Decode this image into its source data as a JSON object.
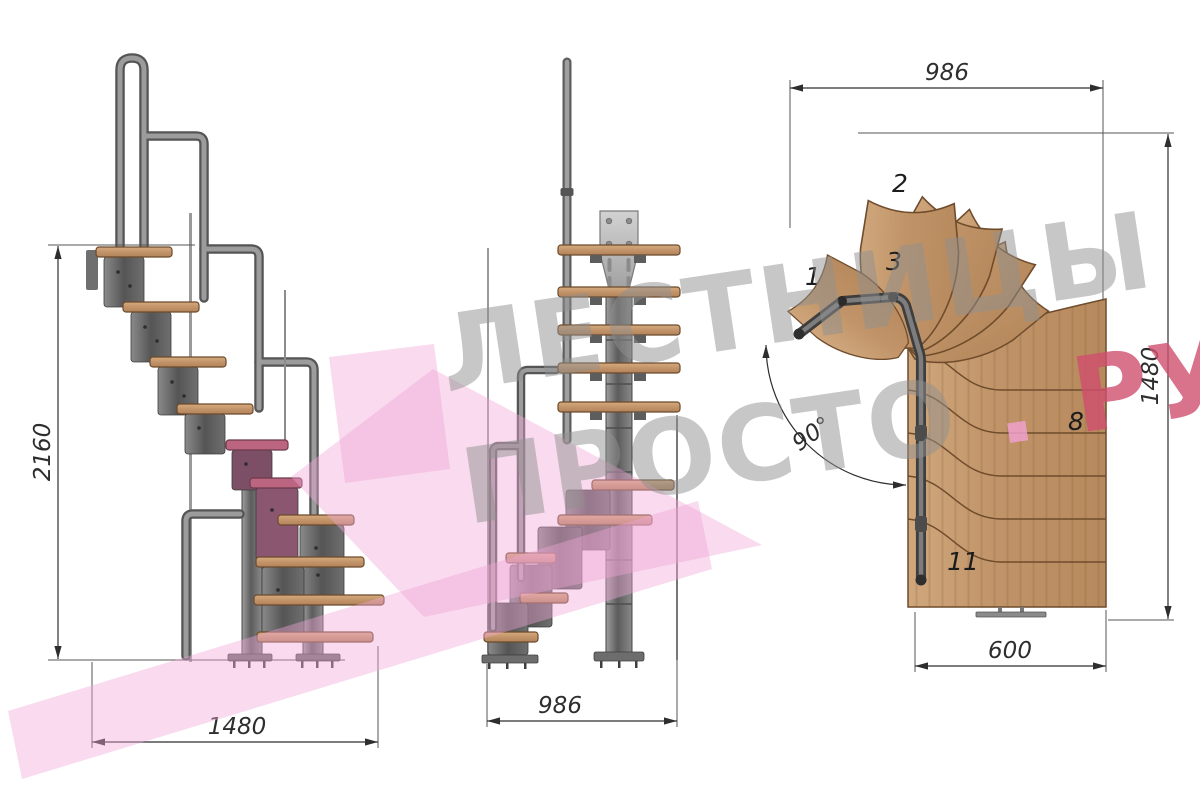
{
  "watermark": {
    "line1": "ЛЕСТНИЦЫ",
    "line2_word": "ПРОСТО",
    "line2_dot": ".",
    "line2_suffix": "РУ"
  },
  "side_view": {
    "dim_height": "2160",
    "dim_run": "1480"
  },
  "front_view": {
    "dim_width": "986"
  },
  "plan_view": {
    "dim_width_top": "986",
    "dim_height_right": "1480",
    "dim_width_bottom": "600",
    "dim_angle": "90°",
    "step_labels": [
      {
        "n": "1"
      },
      {
        "n": "2"
      },
      {
        "n": "3"
      },
      {
        "n": "8"
      },
      {
        "n": "11"
      }
    ]
  },
  "colors": {
    "wood": "#c49a6c",
    "wood_outline": "#6f4c2c",
    "metal": "#7a7a7a",
    "metal_dark": "#4a4a4a",
    "accent_pink": "#f0a8d6",
    "highlight_magenta": "#bb6580",
    "highlight_magenta_dark": "#7c4f66",
    "watermark_gray": "#8f8f8f",
    "watermark_red": "#cf4f6e",
    "watermark_dot_pink": "#f0a0cc"
  }
}
